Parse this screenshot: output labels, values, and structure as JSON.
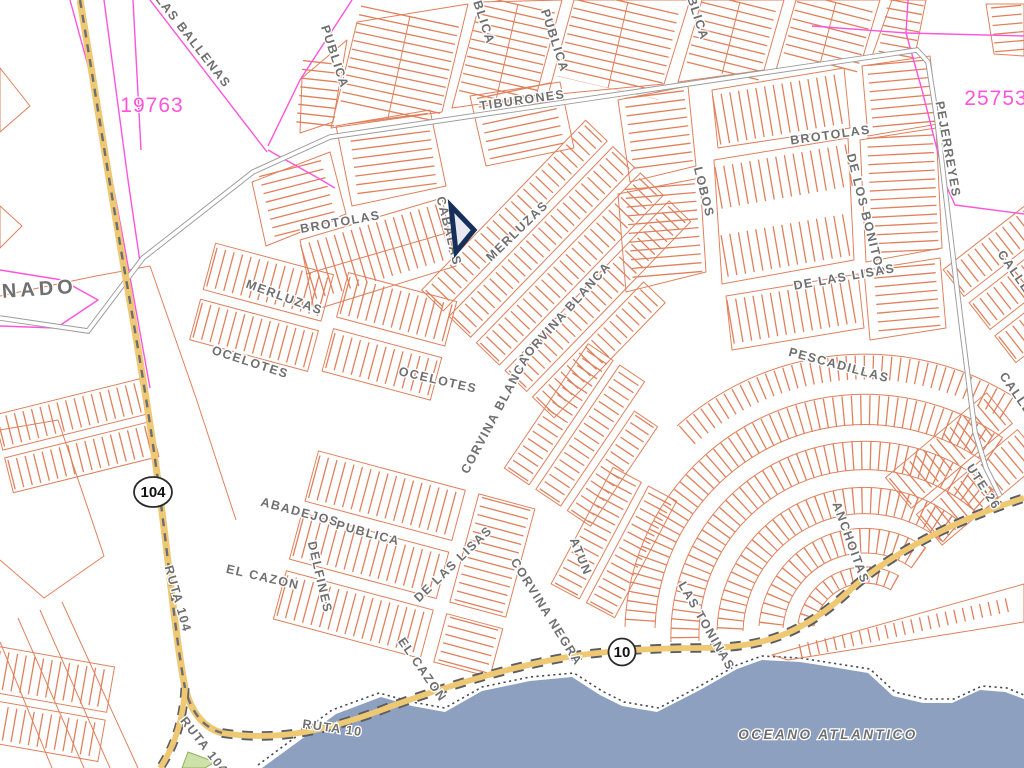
{
  "map": {
    "colors": {
      "parcel_line": "#E0805C",
      "boundary_magenta": "#FF54DC",
      "highway_fill": "#EFC873",
      "highway_casing": "#5A5D63",
      "minor_road_casing": "#9B9B9B",
      "water": "#8EA0C0",
      "street_label": "#6F6F6F",
      "water_label": "#68809F",
      "marker": "#17305B",
      "green_area": "#CCE2A8"
    },
    "street_labels": [
      {
        "text": "LAS BALLENAS",
        "x": 190,
        "y": 44,
        "r": 52
      },
      {
        "text": "PUBLICA",
        "x": 331,
        "y": 58,
        "r": 72
      },
      {
        "text": "PUBLICA",
        "x": 477,
        "y": 14,
        "r": 72
      },
      {
        "text": "PUBLICA",
        "x": 551,
        "y": 42,
        "r": 72
      },
      {
        "text": "PUBLICA",
        "x": 691,
        "y": 10,
        "r": 72
      },
      {
        "text": "TIBURONES",
        "x": 523,
        "y": 104,
        "r": -8
      },
      {
        "text": "BROTOLAS",
        "x": 831,
        "y": 139,
        "r": -8
      },
      {
        "text": "PEJERREYES",
        "x": 944,
        "y": 150,
        "r": 80
      },
      {
        "text": "LOBOS",
        "x": 700,
        "y": 193,
        "r": 76
      },
      {
        "text": "DE LOS BONITOS",
        "x": 862,
        "y": 216,
        "r": 76
      },
      {
        "text": "BROTOLAS",
        "x": 341,
        "y": 226,
        "r": -10
      },
      {
        "text": "CABALAS",
        "x": 445,
        "y": 232,
        "r": 76
      },
      {
        "text": "MERLUZAS",
        "x": 520,
        "y": 234,
        "r": -44
      },
      {
        "text": "MERLUZAS",
        "x": 283,
        "y": 301,
        "r": 20
      },
      {
        "text": "CORVINA BLANCA",
        "x": 567,
        "y": 316,
        "r": -48
      },
      {
        "text": "OCELOTES",
        "x": 249,
        "y": 366,
        "r": 18
      },
      {
        "text": "OCELOTES",
        "x": 437,
        "y": 384,
        "r": 13
      },
      {
        "text": "DE LAS LISAS",
        "x": 845,
        "y": 281,
        "r": -10
      },
      {
        "text": "PESCADILLAS",
        "x": 838,
        "y": 369,
        "r": 15
      },
      {
        "text": "CORVINA BLANCA",
        "x": 499,
        "y": 416,
        "r": -62
      },
      {
        "text": "CALLE",
        "x": 1011,
        "y": 274,
        "r": 55
      },
      {
        "text": "CALLE",
        "x": 1013,
        "y": 396,
        "r": 55
      },
      {
        "text": "ABADEJOS",
        "x": 299,
        "y": 516,
        "r": 15
      },
      {
        "text": "PUBLICA",
        "x": 367,
        "y": 537,
        "r": 15
      },
      {
        "text": "EL CAZON",
        "x": 262,
        "y": 581,
        "r": 13
      },
      {
        "text": "DELFINES",
        "x": 316,
        "y": 578,
        "r": 77
      },
      {
        "text": "DE LAS LISAS",
        "x": 456,
        "y": 567,
        "r": -44
      },
      {
        "text": "ATUN",
        "x": 577,
        "y": 558,
        "r": 68
      },
      {
        "text": "CORVINA NEGRA",
        "x": 543,
        "y": 614,
        "r": 58
      },
      {
        "text": "ANCHOITAS",
        "x": 847,
        "y": 544,
        "r": 70
      },
      {
        "text": "LAS TONINAS",
        "x": 703,
        "y": 628,
        "r": 60
      },
      {
        "text": "EL CAZON",
        "x": 419,
        "y": 672,
        "r": 55
      },
      {
        "text": "RUTA 104",
        "x": 174,
        "y": 600,
        "r": 74,
        "size": 11.5
      },
      {
        "text": "RUTA 104",
        "x": 201,
        "y": 748,
        "r": 52,
        "size": 11.5
      },
      {
        "text": "RUTA 10",
        "x": 332,
        "y": 732,
        "r": 8,
        "size": 11.5
      },
      {
        "text": "UTE-26",
        "x": 980,
        "y": 489,
        "r": 57,
        "size": 10.5
      }
    ],
    "area_labels": [
      {
        "text": "ONADO",
        "x": 30,
        "y": 296,
        "r": -4,
        "size": 20,
        "ls": 4,
        "italic": false,
        "color": "#6F6F6F"
      },
      {
        "text": "OCEANO ATLANTICO",
        "x": 828,
        "y": 739,
        "r": 0,
        "size": 13.5,
        "ls": 2.5,
        "italic": true,
        "color": "#68809F"
      }
    ],
    "parcel_numbers": [
      {
        "text": "19763",
        "x": 152,
        "y": 112
      },
      {
        "text": "25753",
        "x": 996,
        "y": 105
      }
    ],
    "route_shields": [
      {
        "label": "104",
        "x": 153,
        "y": 492,
        "shape": "ellipse"
      },
      {
        "label": "10",
        "x": 622,
        "y": 652,
        "shape": "circle"
      }
    ],
    "marker": {
      "label": "selected-parcel-marker",
      "points": "451,206 474,230 456,252",
      "stroke": "#17305B",
      "fill": "#E9E9F1"
    }
  }
}
